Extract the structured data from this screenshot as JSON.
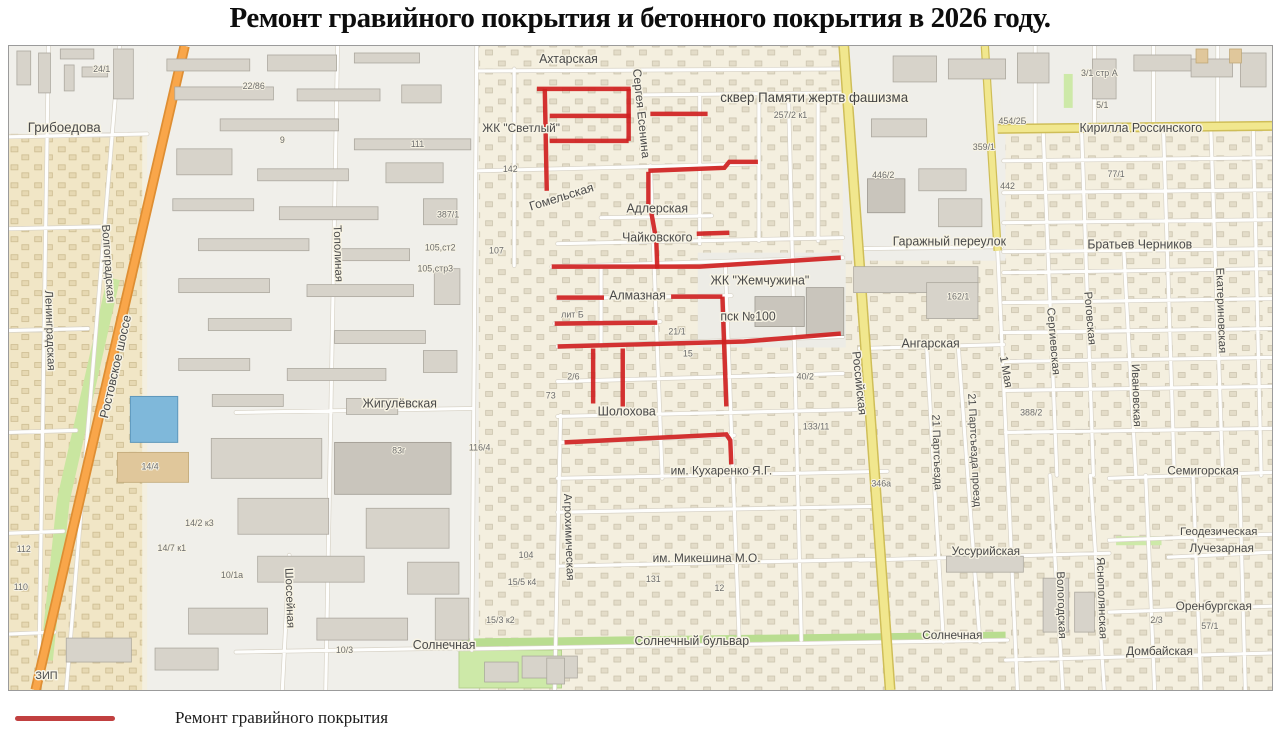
{
  "title": "Ремонт гравийного покрытия и бетонного покрытия в 2026 году.",
  "legend": {
    "items": [
      {
        "label": "Ремонт гравийного покрытия",
        "color": "#C14040"
      }
    ]
  },
  "map": {
    "colors": {
      "repair": "#CF2121",
      "road_orange": "#F9A64A",
      "road_yellow": "#F1E78E",
      "green": "#C9E6A0",
      "water_blue": "#7FB8DA",
      "residential": "#F4EFDF",
      "industrial": "#F0EFEA"
    },
    "labels": [
      {
        "t": "Ахтарская",
        "x": 567,
        "y": 62,
        "s": 12.5
      },
      {
        "t": "Сергея Есенина",
        "x": 637,
        "y": 113,
        "s": 12,
        "r": 84
      },
      {
        "t": "сквер Памяти жертв фашизма",
        "x": 816,
        "y": 101,
        "s": 13.5,
        "c": "area"
      },
      {
        "t": "ЖК \"Светлый\"",
        "x": 519,
        "y": 131,
        "s": 12
      },
      {
        "t": "Гомельская",
        "x": 561,
        "y": 200,
        "s": 12.5,
        "r": -17
      },
      {
        "t": "Адлерская",
        "x": 657,
        "y": 212,
        "s": 12.5
      },
      {
        "t": "Чайковского",
        "x": 657,
        "y": 241,
        "s": 12.5
      },
      {
        "t": "ЖК \"Жемчужина\"",
        "x": 761,
        "y": 284,
        "s": 12.5
      },
      {
        "t": "пск №100",
        "x": 749,
        "y": 320,
        "s": 12.5
      },
      {
        "t": "Алмазная",
        "x": 637,
        "y": 299,
        "s": 12.5
      },
      {
        "t": "Российская",
        "x": 858,
        "y": 383,
        "s": 12,
        "r": 84
      },
      {
        "t": "Ангарская",
        "x": 934,
        "y": 347,
        "s": 12.5
      },
      {
        "t": "Гаражный переулок",
        "x": 953,
        "y": 245,
        "s": 12.5
      },
      {
        "t": "Братьев Черников",
        "x": 1146,
        "y": 248,
        "s": 12.5
      },
      {
        "t": "Кирилла Россинского",
        "x": 1147,
        "y": 131,
        "s": 12.5
      },
      {
        "t": "Грибоедова",
        "x": 56,
        "y": 131,
        "s": 13.5
      },
      {
        "t": "Ленинградская",
        "x": 38,
        "y": 330,
        "s": 11.5,
        "r": 88
      },
      {
        "t": "Волгоградская",
        "x": 97,
        "y": 263,
        "s": 11.5,
        "r": 86
      },
      {
        "t": "Ростовское шоссе",
        "x": 112,
        "y": 367,
        "s": 12.5,
        "r": -77
      },
      {
        "t": "Тополиная",
        "x": 330,
        "y": 253,
        "s": 11.5,
        "r": 88
      },
      {
        "t": "Жигулёвская",
        "x": 396,
        "y": 407,
        "s": 12.5
      },
      {
        "t": "Шолохова",
        "x": 626,
        "y": 415,
        "s": 12.5
      },
      {
        "t": "им. Кухаренко Я.Г.",
        "x": 722,
        "y": 474,
        "s": 12
      },
      {
        "t": "Агрохимическая",
        "x": 564,
        "y": 537,
        "s": 11.5,
        "r": 88
      },
      {
        "t": "им. Микешина М.О.",
        "x": 707,
        "y": 562,
        "s": 12
      },
      {
        "t": "Солнечный бульвар",
        "x": 692,
        "y": 645,
        "s": 12.5
      },
      {
        "t": "Солнечная",
        "x": 441,
        "y": 649,
        "s": 12.5
      },
      {
        "t": "Шоссейная",
        "x": 281,
        "y": 598,
        "s": 11.5,
        "r": 88
      },
      {
        "t": "Уссурийская",
        "x": 990,
        "y": 555,
        "s": 12
      },
      {
        "t": "Солнечная",
        "x": 956,
        "y": 639,
        "s": 12
      },
      {
        "t": "Домбайская",
        "x": 1166,
        "y": 655,
        "s": 12
      },
      {
        "t": "Оренбургская",
        "x": 1221,
        "y": 610,
        "s": 12
      },
      {
        "t": "Лучезарная",
        "x": 1229,
        "y": 552,
        "s": 12
      },
      {
        "t": "Геодезическая",
        "x": 1226,
        "y": 535,
        "s": 11.5
      },
      {
        "t": "Семигорская",
        "x": 1210,
        "y": 474,
        "s": 12
      },
      {
        "t": "Вологодская",
        "x": 1063,
        "y": 605,
        "s": 11.5,
        "r": 88
      },
      {
        "t": "Яснополянская",
        "x": 1104,
        "y": 598,
        "s": 11.5,
        "r": 88
      },
      {
        "t": "Ивановская",
        "x": 1139,
        "y": 395,
        "s": 11.5,
        "r": 88
      },
      {
        "t": "Екатериновская",
        "x": 1225,
        "y": 310,
        "s": 11.5,
        "r": 88
      },
      {
        "t": "Сергиевская",
        "x": 1055,
        "y": 341,
        "s": 11.5,
        "r": 85
      },
      {
        "t": "Роговская",
        "x": 1092,
        "y": 318,
        "s": 11.5,
        "r": 85
      },
      {
        "t": "1 Мая",
        "x": 1007,
        "y": 372,
        "s": 11.5,
        "r": 80
      },
      {
        "t": "21 Партсъезда проезд",
        "x": 975,
        "y": 450,
        "s": 11,
        "r": 87
      },
      {
        "t": "21 Партсъезда",
        "x": 937,
        "y": 452,
        "s": 11,
        "r": 88
      },
      {
        "t": "ЗИП",
        "x": 38,
        "y": 679,
        "s": 11
      },
      {
        "t": "лит Б",
        "x": 571,
        "y": 317,
        "s": 9,
        "c": "num"
      },
      {
        "t": "24/1",
        "x": 94,
        "y": 71,
        "s": 9,
        "c": "num"
      },
      {
        "t": "22/86",
        "x": 248,
        "y": 88,
        "s": 9,
        "c": "num"
      },
      {
        "t": "9",
        "x": 277,
        "y": 142,
        "s": 9,
        "c": "num"
      },
      {
        "t": "111",
        "x": 414,
        "y": 146,
        "s": 9,
        "c": "num"
      },
      {
        "t": "387/1",
        "x": 445,
        "y": 217,
        "s": 9,
        "c": "num"
      },
      {
        "t": "105,ст2",
        "x": 437,
        "y": 250,
        "s": 9,
        "c": "num"
      },
      {
        "t": "105,стр3",
        "x": 432,
        "y": 271,
        "s": 9,
        "c": "num"
      },
      {
        "t": "14/4",
        "x": 143,
        "y": 469,
        "s": 9,
        "c": "num"
      },
      {
        "t": "142",
        "x": 508,
        "y": 171,
        "s": 9,
        "c": "num"
      },
      {
        "t": "107",
        "x": 494,
        "y": 253,
        "s": 9,
        "c": "num"
      },
      {
        "t": "446/2",
        "x": 886,
        "y": 177,
        "s": 9,
        "c": "num"
      },
      {
        "t": "442",
        "x": 1012,
        "y": 188,
        "s": 9,
        "c": "num"
      },
      {
        "t": "359/1",
        "x": 988,
        "y": 149,
        "s": 9,
        "c": "num"
      },
      {
        "t": "454/2Б",
        "x": 1017,
        "y": 123,
        "s": 9,
        "c": "num"
      },
      {
        "t": "257/2 к1",
        "x": 792,
        "y": 117,
        "s": 9,
        "c": "num"
      },
      {
        "t": "162/1",
        "x": 962,
        "y": 299,
        "s": 9,
        "c": "num"
      },
      {
        "t": "388/2",
        "x": 1036,
        "y": 415,
        "s": 9,
        "c": "num"
      },
      {
        "t": "346а",
        "x": 884,
        "y": 486,
        "s": 9,
        "c": "num"
      },
      {
        "t": "104",
        "x": 524,
        "y": 558,
        "s": 9,
        "c": "num"
      },
      {
        "t": "15/5 к4",
        "x": 520,
        "y": 585,
        "s": 9,
        "c": "num"
      },
      {
        "t": "15/3 к2",
        "x": 498,
        "y": 623,
        "s": 9,
        "c": "num"
      },
      {
        "t": "14/2 к3",
        "x": 193,
        "y": 526,
        "s": 9,
        "c": "num"
      },
      {
        "t": "14/7 к1",
        "x": 165,
        "y": 551,
        "s": 9,
        "c": "num"
      },
      {
        "t": "10/1а",
        "x": 226,
        "y": 578,
        "s": 9,
        "c": "num"
      },
      {
        "t": "112",
        "x": 15,
        "y": 552,
        "s": 9,
        "c": "num"
      },
      {
        "t": "110",
        "x": 12,
        "y": 590,
        "s": 9,
        "c": "num"
      },
      {
        "t": "133/11",
        "x": 818,
        "y": 429,
        "s": 9,
        "c": "num"
      },
      {
        "t": "3/1 стр А",
        "x": 1105,
        "y": 75,
        "s": 9,
        "c": "num"
      },
      {
        "t": "5/1",
        "x": 1108,
        "y": 107,
        "s": 9,
        "c": "num"
      },
      {
        "t": "77/1",
        "x": 1122,
        "y": 176,
        "s": 9,
        "c": "num"
      },
      {
        "t": "10/3",
        "x": 340,
        "y": 653,
        "s": 9,
        "c": "num"
      },
      {
        "t": "83г",
        "x": 395,
        "y": 453,
        "s": 9,
        "c": "num"
      },
      {
        "t": "116/4",
        "x": 477,
        "y": 450,
        "s": 9,
        "c": "num"
      },
      {
        "t": "2/6",
        "x": 572,
        "y": 379,
        "s": 9,
        "c": "num"
      },
      {
        "t": "73",
        "x": 549,
        "y": 398,
        "s": 9,
        "c": "num"
      },
      {
        "t": "15",
        "x": 688,
        "y": 356,
        "s": 9,
        "c": "num"
      },
      {
        "t": "21/1",
        "x": 677,
        "y": 334,
        "s": 9,
        "c": "num"
      },
      {
        "t": "131",
        "x": 653,
        "y": 582,
        "s": 9,
        "c": "num"
      },
      {
        "t": "12",
        "x": 720,
        "y": 591,
        "s": 9,
        "c": "num"
      },
      {
        "t": "57/1",
        "x": 1217,
        "y": 629,
        "s": 9,
        "c": "num"
      },
      {
        "t": "40/2",
        "x": 807,
        "y": 379,
        "s": 9,
        "c": "num"
      },
      {
        "t": "2/3",
        "x": 1163,
        "y": 623,
        "s": 9,
        "c": "num"
      }
    ],
    "repair_lines": [
      [
        [
          535,
          88
        ],
        [
          630,
          88
        ]
      ],
      [
        [
          543,
          88
        ],
        [
          545,
          190
        ]
      ],
      [
        [
          548,
          115
        ],
        [
          630,
          115
        ]
      ],
      [
        [
          548,
          140
        ],
        [
          628,
          140
        ]
      ],
      [
        [
          628,
          88
        ],
        [
          628,
          140
        ]
      ],
      [
        [
          650,
          113
        ],
        [
          708,
          113
        ]
      ],
      [
        [
          648,
          171
        ],
        [
          648,
          208
        ]
      ],
      [
        [
          648,
          170
        ],
        [
          725,
          167
        ],
        [
          730,
          161
        ],
        [
          759,
          161
        ]
      ],
      [
        [
          651,
          212
        ],
        [
          656,
          240
        ],
        [
          657,
          268
        ]
      ],
      [
        [
          697,
          233
        ],
        [
          730,
          232
        ]
      ],
      [
        [
          550,
          266
        ],
        [
          700,
          266
        ],
        [
          843,
          257
        ]
      ],
      [
        [
          555,
          297
        ],
        [
          603,
          297
        ]
      ],
      [
        [
          671,
          296
        ],
        [
          723,
          296
        ]
      ],
      [
        [
          723,
          296
        ],
        [
          727,
          406
        ]
      ],
      [
        [
          553,
          323
        ],
        [
          657,
          322
        ]
      ],
      [
        [
          556,
          346
        ],
        [
          745,
          341
        ],
        [
          843,
          333
        ]
      ],
      [
        [
          592,
          348
        ],
        [
          592,
          403
        ]
      ],
      [
        [
          622,
          348
        ],
        [
          622,
          406
        ]
      ],
      [
        [
          563,
          442
        ],
        [
          727,
          434
        ],
        [
          731,
          440
        ],
        [
          732,
          464
        ]
      ]
    ]
  }
}
